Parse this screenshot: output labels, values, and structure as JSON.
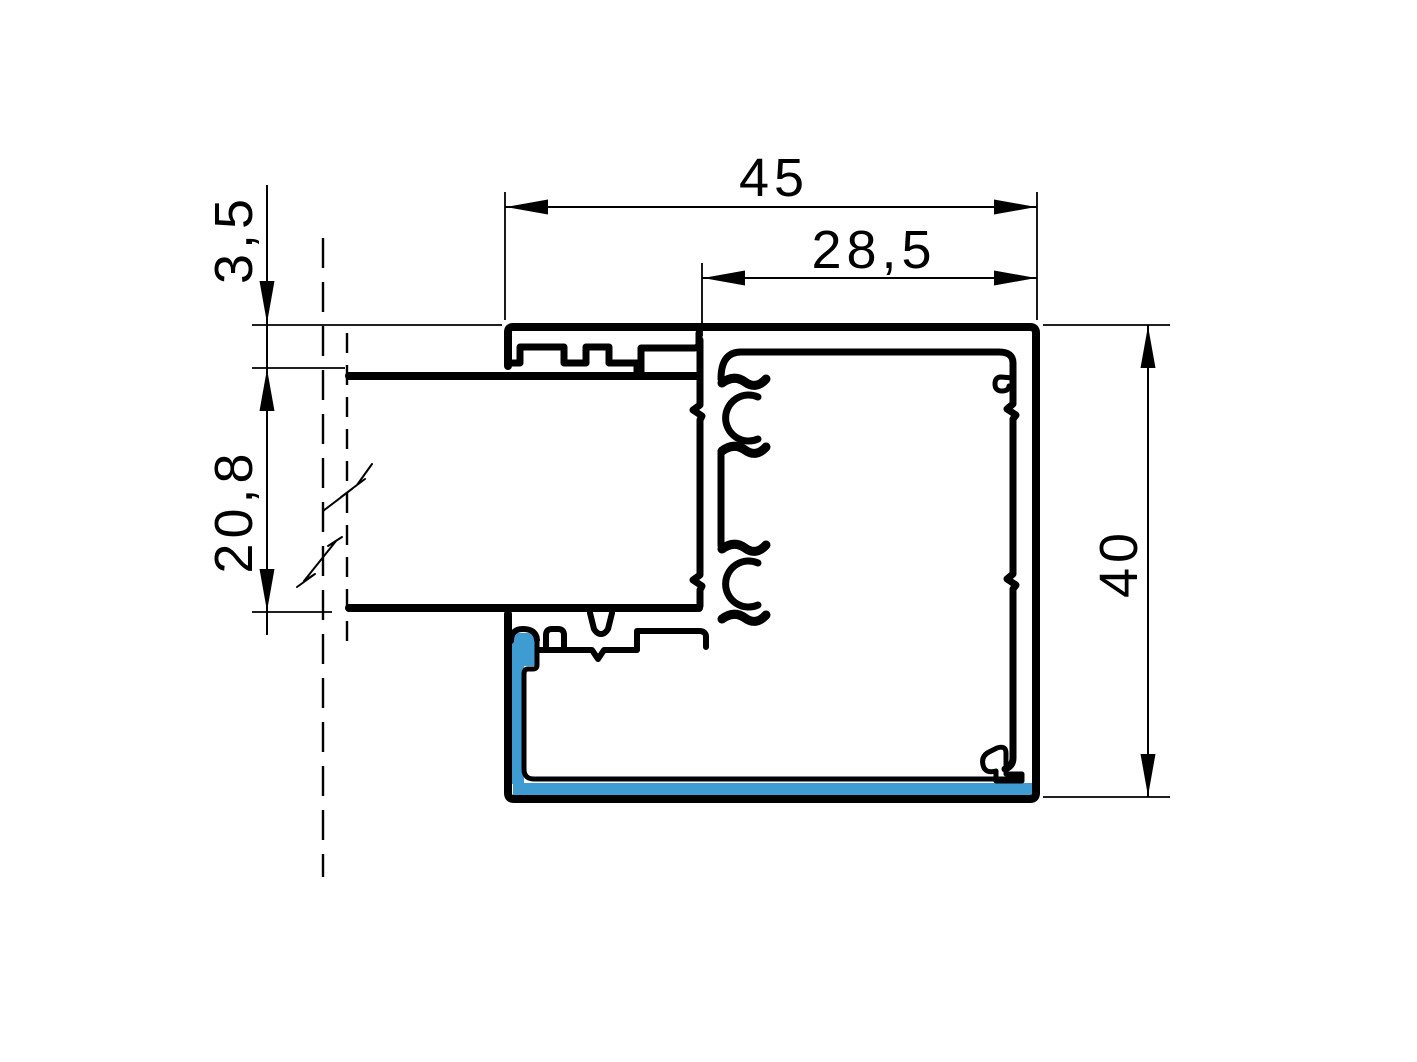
{
  "meta": {
    "title": "Aluminium window frame profile cross-section drawing"
  },
  "colors": {
    "line": "#000000",
    "highlight": "#3F9CD2",
    "background": "#FFFFFF"
  },
  "dimensions": {
    "top_width": "45",
    "glazing_rebate_width": "28,5",
    "front_lip": "3,5",
    "glazing_thickness": "20,8",
    "profile_height": "40"
  }
}
